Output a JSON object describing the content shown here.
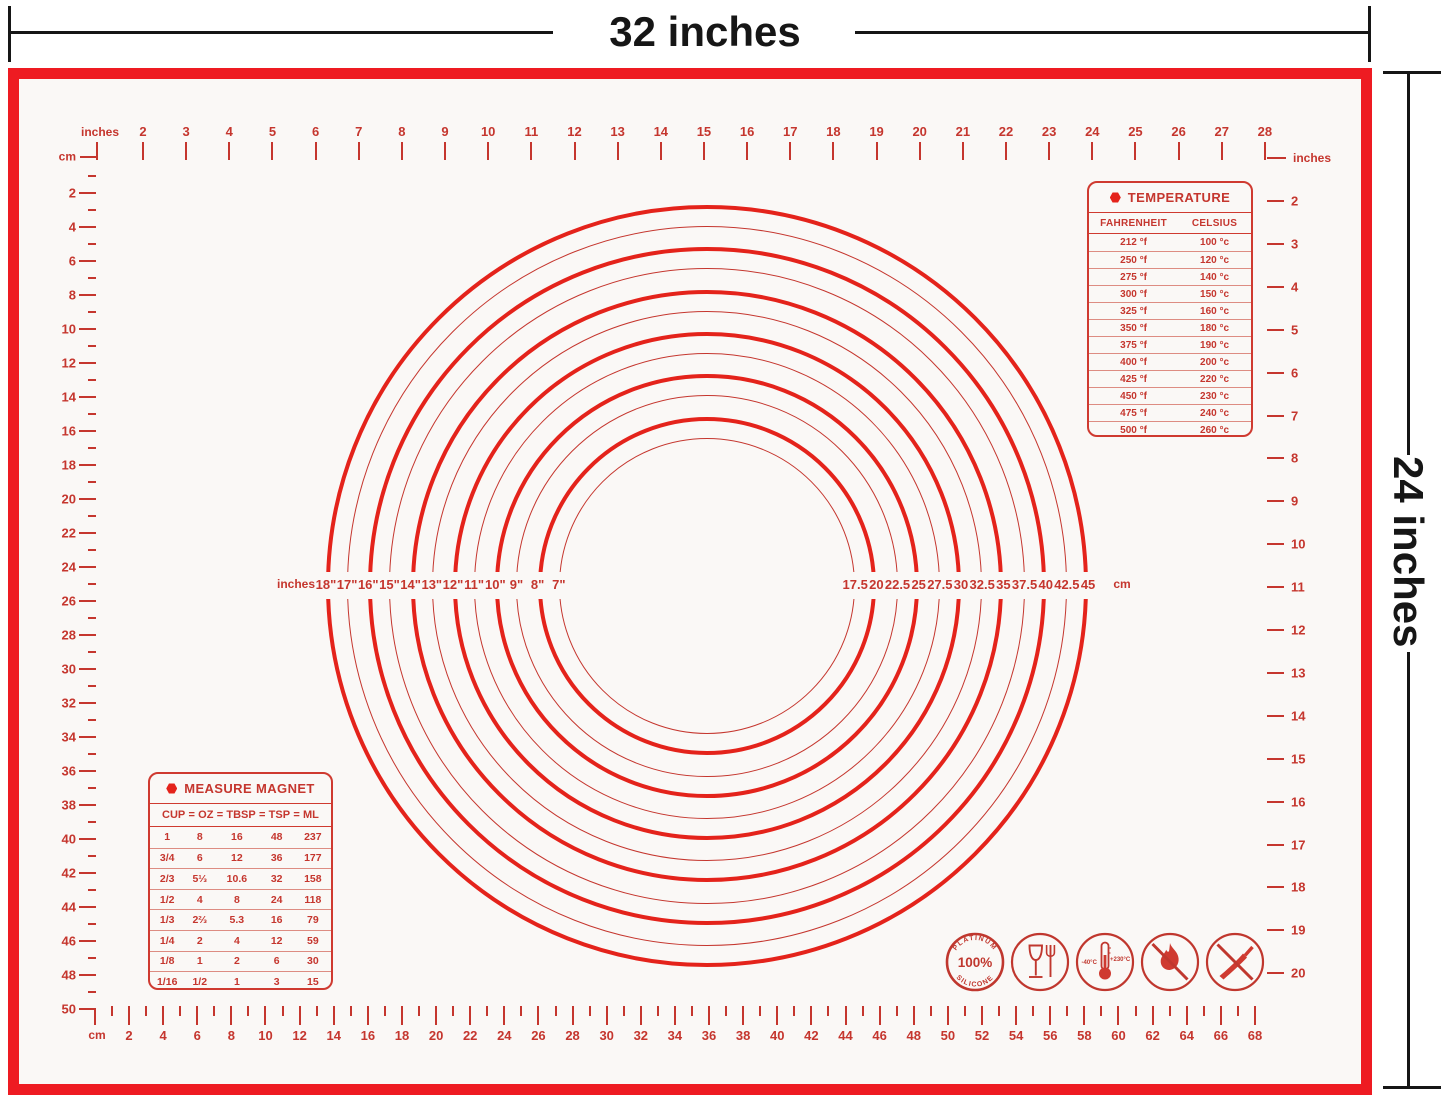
{
  "dimension_annotations": {
    "width_label": "32 inches",
    "height_label": "24 inches",
    "line_color": "#161616"
  },
  "mat": {
    "border_color": "#ee1b22",
    "marking_color": "#c5362e",
    "surface_color": "#faf8f6"
  },
  "rulers": {
    "top_inches": {
      "unit_label": "inches",
      "values": [
        2,
        3,
        4,
        5,
        6,
        7,
        8,
        9,
        10,
        11,
        12,
        13,
        14,
        15,
        16,
        17,
        18,
        19,
        20,
        21,
        22,
        23,
        24,
        25,
        26,
        27,
        28
      ]
    },
    "left_cm": {
      "unit_label": "cm",
      "values": [
        2,
        4,
        6,
        8,
        10,
        12,
        14,
        16,
        18,
        20,
        22,
        24,
        26,
        28,
        30,
        32,
        34,
        36,
        38,
        40,
        42,
        44,
        46,
        48,
        50
      ]
    },
    "right_inches": {
      "unit_label": "inches",
      "values": [
        2,
        3,
        4,
        5,
        6,
        7,
        8,
        9,
        10,
        11,
        12,
        13,
        14,
        15,
        16,
        17,
        18,
        19,
        20
      ]
    },
    "bottom_cm": {
      "unit_label": "cm",
      "values": [
        2,
        4,
        6,
        8,
        10,
        12,
        14,
        16,
        18,
        20,
        22,
        24,
        26,
        28,
        30,
        32,
        34,
        36,
        38,
        40,
        42,
        44,
        46,
        48,
        50,
        52,
        54,
        56,
        58,
        60,
        62,
        64,
        66,
        68
      ]
    }
  },
  "circle_guides": {
    "left_unit_label": "inches",
    "right_unit_label": "cm",
    "diameters_in": [
      18,
      17,
      16,
      15,
      14,
      13,
      12,
      11,
      10,
      9,
      8,
      7
    ],
    "labels_inches": [
      "18\"",
      "17\"",
      "16\"",
      "15\"",
      "14\"",
      "13\"",
      "12\"",
      "11\"",
      "10\"",
      "9\"",
      "8\"",
      "7\""
    ],
    "labels_cm": [
      "17.5",
      "20",
      "22.5",
      "25",
      "27.5",
      "30",
      "32.5",
      "35",
      "37.5",
      "40",
      "42.5",
      "45"
    ]
  },
  "temperature_table": {
    "title": "TEMPERATURE",
    "columns": [
      "FAHRENHEIT",
      "CELSIUS"
    ],
    "rows": [
      [
        "212 °f",
        "100 °c"
      ],
      [
        "250 °f",
        "120 °c"
      ],
      [
        "275 °f",
        "140 °c"
      ],
      [
        "300 °f",
        "150 °c"
      ],
      [
        "325 °f",
        "160 °c"
      ],
      [
        "350 °f",
        "180 °c"
      ],
      [
        "375 °f",
        "190 °c"
      ],
      [
        "400 °f",
        "200 °c"
      ],
      [
        "425 °f",
        "220 °c"
      ],
      [
        "450 °f",
        "230 °c"
      ],
      [
        "475 °f",
        "240 °c"
      ],
      [
        "500 °f",
        "260 °c"
      ]
    ]
  },
  "measure_table": {
    "title": "MEASURE MAGNET",
    "columns": [
      "CUP",
      "OZ",
      "TBSP",
      "TSP",
      "ML"
    ],
    "separator": "=",
    "rows": [
      [
        "1",
        "8",
        "16",
        "48",
        "237"
      ],
      [
        "3/4",
        "6",
        "12",
        "36",
        "177"
      ],
      [
        "2/3",
        "5⅓",
        "10.6",
        "32",
        "158"
      ],
      [
        "1/2",
        "4",
        "8",
        "24",
        "118"
      ],
      [
        "1/3",
        "2⅔",
        "5.3",
        "16",
        "79"
      ],
      [
        "1/4",
        "2",
        "4",
        "12",
        "59"
      ],
      [
        "1/8",
        "1",
        "2",
        "6",
        "30"
      ],
      [
        "1/16",
        "1/2",
        "1",
        "3",
        "15"
      ]
    ]
  },
  "icons": {
    "badge": {
      "top": "PLATINUM",
      "middle": "100%",
      "bottom": "SILICONE"
    },
    "food_safe": "glass-and-fork",
    "temp_range": {
      "min": "-40°C",
      "max": "+230°C"
    },
    "no_flame": "crossed-out-flame",
    "no_knife": "crossed-out-knife"
  }
}
